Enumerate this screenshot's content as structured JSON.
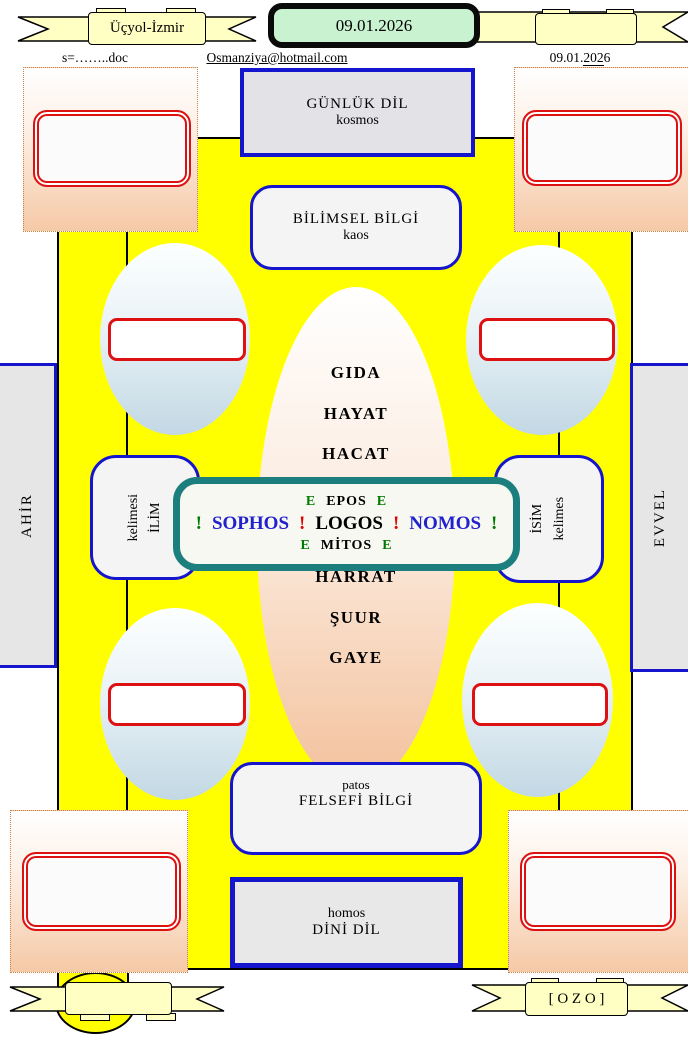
{
  "header": {
    "left_banner_label": "Üçyol-İzmir",
    "right_banner_label": "",
    "date_plaque": "09.01.2026",
    "doc_ref": "s=……..doc",
    "email": "Osmanziya@hotmail.com",
    "date_right_prefix": "09.01.",
    "date_right_underlined": "202",
    "date_right_suffix": "6"
  },
  "boxes": {
    "gunluk": {
      "line1": "GÜNLÜK  DİL",
      "line2": "kosmos"
    },
    "bilimsel": {
      "line1": "BİLİMSEL BİLGİ",
      "line2": "kaos"
    },
    "felsefi": {
      "line1": "patos",
      "line2": "FELSEFİ  BİLGİ"
    },
    "dini": {
      "line1": "homos",
      "line2": "DİNİ DİL"
    }
  },
  "sides": {
    "left_bar": "AHİR",
    "right_bar": "EVVEL",
    "left_box_line1": "kelimesi",
    "left_box_line2": "İLİM",
    "right_box_line1": "İSİM",
    "right_box_line2": "kelimes"
  },
  "center": {
    "top_words": [
      "GIDA",
      "HAYAT",
      "HACAT"
    ],
    "bottom_words": [
      "HARRAT",
      "ŞUUR",
      "GAYE"
    ],
    "epos_row": [
      {
        "t": "E",
        "c": "green"
      },
      {
        "t": "EPOS",
        "c": "black"
      },
      {
        "t": "E",
        "c": "green"
      }
    ],
    "main_row": [
      {
        "t": "!",
        "c": "green"
      },
      {
        "t": "SOPHOS",
        "c": "blue"
      },
      {
        "t": "!",
        "c": "red"
      },
      {
        "t": "LOGOS",
        "c": "black"
      },
      {
        "t": "!",
        "c": "red"
      },
      {
        "t": "NOMOS",
        "c": "blue"
      },
      {
        "t": "!",
        "c": "green"
      }
    ],
    "mitos_row": [
      {
        "t": "E",
        "c": "green"
      },
      {
        "t": "MİTOS",
        "c": "black"
      },
      {
        "t": "E",
        "c": "green"
      }
    ]
  },
  "footer": {
    "left_banner_label": "",
    "right_banner_label": "[ O Z O ]"
  },
  "colors": {
    "green": "#007a00",
    "red": "#e00000",
    "blue": "#2222cc",
    "black": "#000000",
    "yellow": "#ffff00",
    "teal": "#1d7f7d",
    "ribbon": "#ffffc4",
    "plaque_green": "#c8f2d0",
    "border_blue": "#1515cd",
    "border_red": "#dd1111"
  }
}
